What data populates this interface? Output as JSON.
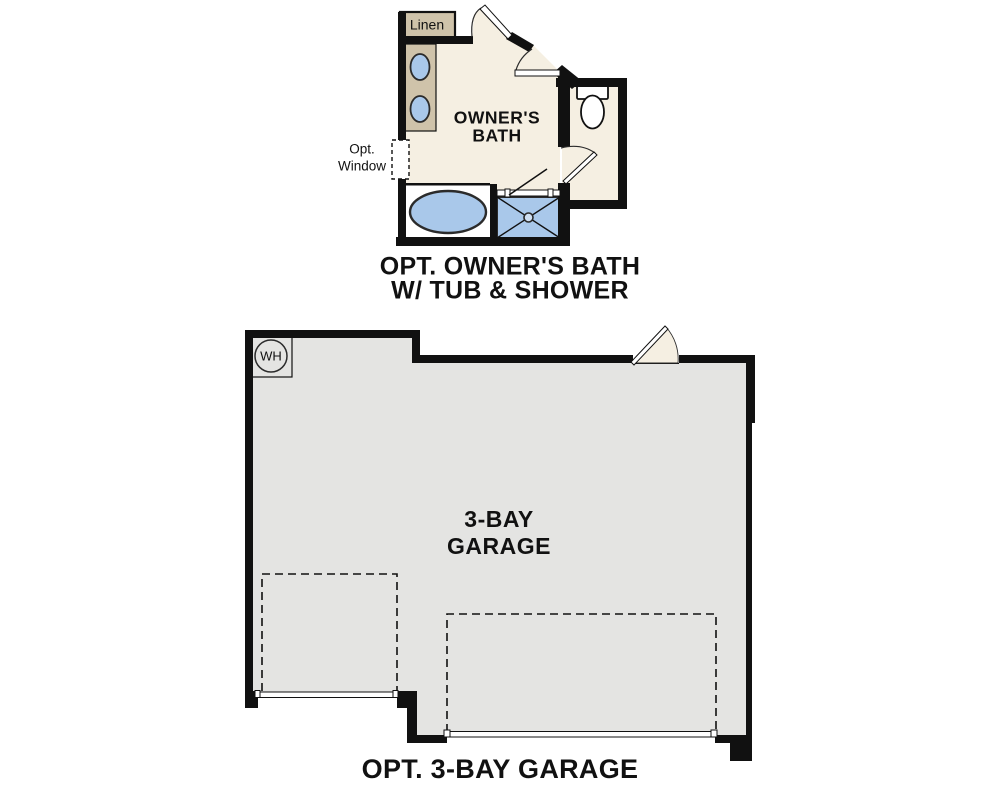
{
  "figures": {
    "bath": {
      "title_line1": "OPT. OWNER'S BATH",
      "title_line2": "W/ TUB & SHOWER",
      "room_label_line1": "OWNER'S",
      "room_label_line2": "BATH",
      "linen_label": "Linen",
      "window_label_line1": "Opt.",
      "window_label_line2": "Window"
    },
    "garage": {
      "title": "OPT. 3-BAY GARAGE",
      "room_label_line1": "3-BAY",
      "room_label_line2": "GARAGE",
      "water_heater_label": "WH"
    }
  },
  "colors": {
    "wall": "#111111",
    "outline": "#2b2b2b",
    "text": "#111111",
    "bath_floor": "#f5efe2",
    "cabinet": "#cfc3aa",
    "fixture_blue": "#a9c8ea",
    "fixture_blue_light": "#cfdff1",
    "garage_floor": "#e4e4e2",
    "background": "#ffffff"
  }
}
